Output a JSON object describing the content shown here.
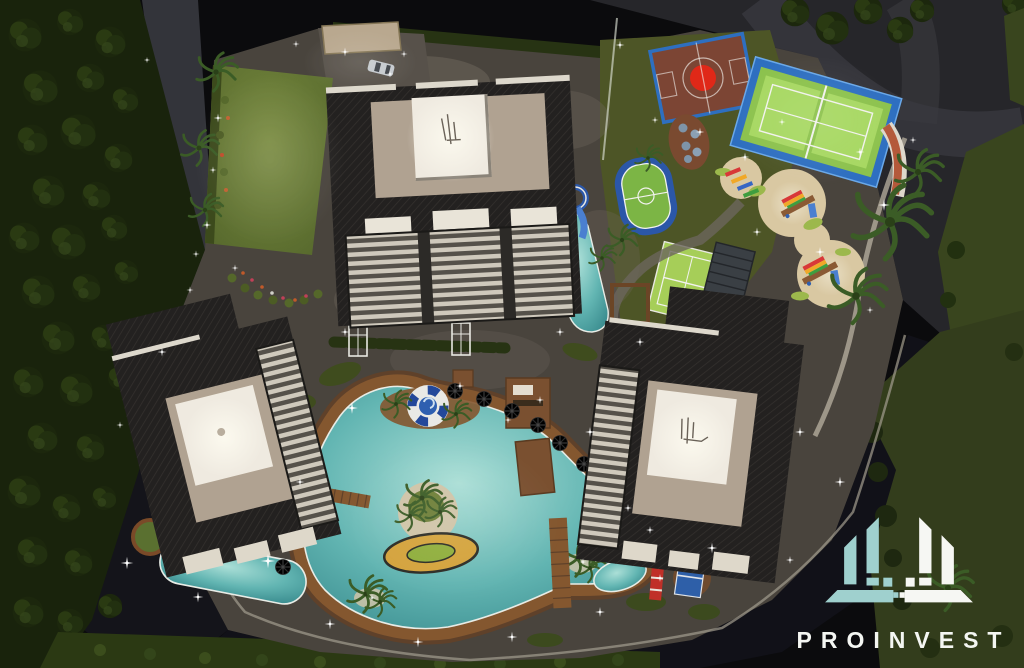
{
  "logo": {
    "brand": "PROINVEST",
    "icon": "proinvest-buildings-icon"
  },
  "scene": {
    "type": "aerial-night-architectural-render",
    "features": [
      "central-tower",
      "west-tower",
      "east-tower",
      "lagoon-pool",
      "kids-gold-pool",
      "lap-pool",
      "waterslide",
      "lifering-slide",
      "basketball-court",
      "padel-court",
      "mini-football-pitch",
      "small-tennis-court",
      "playground",
      "outdoor-fitness",
      "table-tennis",
      "lawn",
      "entrance-canopy",
      "car",
      "palm-trees",
      "street-lights"
    ]
  },
  "colors": {
    "night_bg": "#0a0a0c",
    "asphalt": "#27272b",
    "asphalt_light": "#3a3a40",
    "road_dark": "#111118",
    "pavement": "#57514a",
    "pavement_light": "#6f685e",
    "lawn": "#6d7e37",
    "grass_right": "#39451e",
    "grass_dark": "#1a230c",
    "hedge": "#273313",
    "bush": "#2f3d16",
    "palm": "#3b5c26",
    "roof": "#232120",
    "roof_line": "#34312f",
    "facade_beige": "#b0a291",
    "rooftop_white": "#efeae0",
    "balcony_light": "#cfc9bc",
    "balcony_dark": "#57534b",
    "pool_light": "#a8ded6",
    "pool_teal": "#62b5b2",
    "pool_deep": "#37898c",
    "deck_wood": "#84572f",
    "deck_dark": "#5f412a",
    "court_clay": "#7c4534",
    "court_red": "#e02818",
    "sport_blue": "#2e6fc0",
    "track_blue": "#2b57a8",
    "turf": "#8cc24d",
    "turf_light": "#a7d862",
    "sand": "#d9c8a2",
    "gold": "#d4a33c",
    "island_green": "#8fae3c",
    "white_line": "#f2f2ee",
    "terracotta": "#b4593a",
    "sparkle": "#ffffff",
    "logo_teal": "#9fd0ce",
    "logo_white": "#f6f7f3",
    "brand_text": "#f4f6f2"
  }
}
